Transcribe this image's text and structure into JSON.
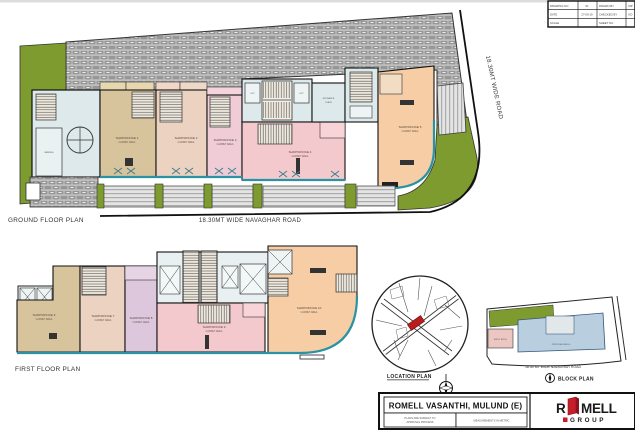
{
  "colors": {
    "paving_grey": "#979797",
    "landscape_green": "#7d9b2f",
    "room_blue": "#dde9ea",
    "room_tan": "#d8c49c",
    "room_peach": "#ecd2c0",
    "room_lavender": "#efccd6",
    "room_pink": "#f4c9cd",
    "room_orange": "#f6cda4",
    "storefront_teal": "#2a93a3",
    "block_building_blue": "#b9cfe0",
    "plot_red": "#b91c1c",
    "logo_red": "#c41e2a"
  },
  "ground_floor": {
    "title": "GROUND FLOOR PLAN",
    "road_label": "18.30MT WIDE NAVAGHAR ROAD",
    "side_road_label": "18.30MT WIDE ROAD",
    "lift_label_left": "LIFT",
    "lift_label_right": "LIFT",
    "entrance_lobby_line1": "ENTRANCE",
    "entrance_lobby_line2": "LOBBY",
    "parking_label": "PARKING",
    "shops": [
      {
        "name": "SHOP/OFFICE 1",
        "sub": "CARPET AREA"
      },
      {
        "name": "SHOP/OFFICE 2",
        "sub": "CARPET AREA"
      },
      {
        "name": "SHOP/OFFICE 3",
        "sub": "CARPET AREA"
      },
      {
        "name": "SHOP/OFFICE 4",
        "sub": "CARPET AREA"
      },
      {
        "name": "SHOP/OFFICE 5",
        "sub": "CARPET AREA"
      }
    ]
  },
  "first_floor": {
    "title": "FIRST FLOOR PLAN",
    "shops": [
      {
        "name": "SHOP/OFFICE 6",
        "sub": "CARPET AREA"
      },
      {
        "name": "SHOP/OFFICE 7",
        "sub": "CARPET AREA"
      },
      {
        "name": "SHOP/OFFICE 8",
        "sub": "CARPET AREA"
      },
      {
        "name": "SHOP/OFFICE 9",
        "sub": "CARPET AREA"
      },
      {
        "name": "SHOP/OFFICE 10",
        "sub": "CARPET AREA"
      }
    ]
  },
  "location_plan": {
    "label": "LOCATION PLAN"
  },
  "block_plan": {
    "label": "BLOCK PLAN",
    "road_label": "18.30 MT WIDE NAVAGHAR ROAD",
    "side_road_label": "18.30 MT WIDE RD",
    "building_label": "PROPOSED BLDG.",
    "existing_label": "EXIST. BLDG."
  },
  "title_block": {
    "project_title": "ROMELL VASANTHI, MULUND (E)",
    "note_left_line1": "PLANS ARE SUBJECT TO",
    "note_left_line2": "APPROVAL PROCESS",
    "note_right": "MEASUREMENTS IN METRIC",
    "logo_prefix": "R",
    "logo_suffix": "MELL",
    "logo_group": "GROUP"
  },
  "revision_table": {
    "rows": [
      {
        "c1": "DRAWING NO",
        "c2": "01",
        "c3": "DRAWN BY",
        "c4": "MP"
      },
      {
        "c1": "DATE",
        "c2": "27-09-19",
        "c3": "CHECKED BY",
        "c4": "KD"
      },
      {
        "c1": "SCALE",
        "c2": "",
        "c3": "SHEET NO",
        "c4": ""
      }
    ]
  }
}
